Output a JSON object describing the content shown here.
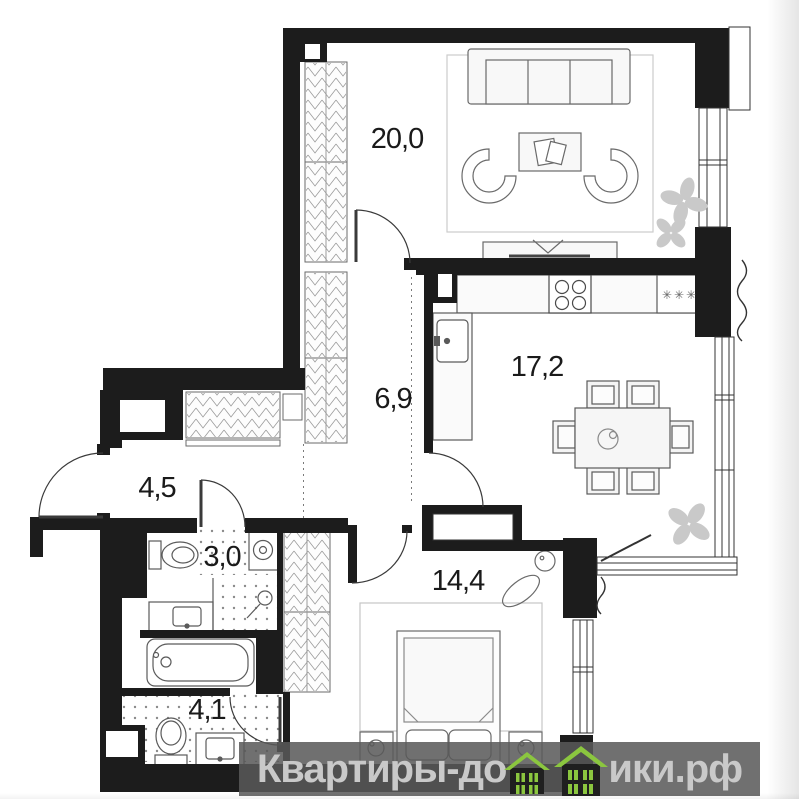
{
  "plan": {
    "type": "apartment-floor-plan",
    "rooms": [
      {
        "name": "living-room",
        "area_label": "20,0"
      },
      {
        "name": "kitchen-dining",
        "area_label": "17,2"
      },
      {
        "name": "hallway",
        "area_label": "6,9"
      },
      {
        "name": "entry-corridor",
        "area_label": "4,5"
      },
      {
        "name": "wc",
        "area_label": "3,0"
      },
      {
        "name": "bedroom",
        "area_label": "14,4"
      },
      {
        "name": "bathroom",
        "area_label": "4,1"
      }
    ],
    "kitchen": {
      "fridge_symbol": "✳✳✳"
    },
    "colors": {
      "wall": "#1c1c1c",
      "furniture_stroke": "#5a5a5a",
      "light_fill": "#f7f7f7",
      "hatch": "#9a9a9a",
      "plant": "#c9c9c9",
      "label_text": "#1a1a1a"
    }
  },
  "watermark": {
    "text_before": "Квартиры-до",
    "text_after": "ики.рф",
    "hidden_letter": "м",
    "site_name": "Квартиры-домики.рф",
    "band_color": "rgba(88,88,88,0.86)",
    "text_color": "#c9c9c9",
    "house_green": "#8bc63f"
  }
}
